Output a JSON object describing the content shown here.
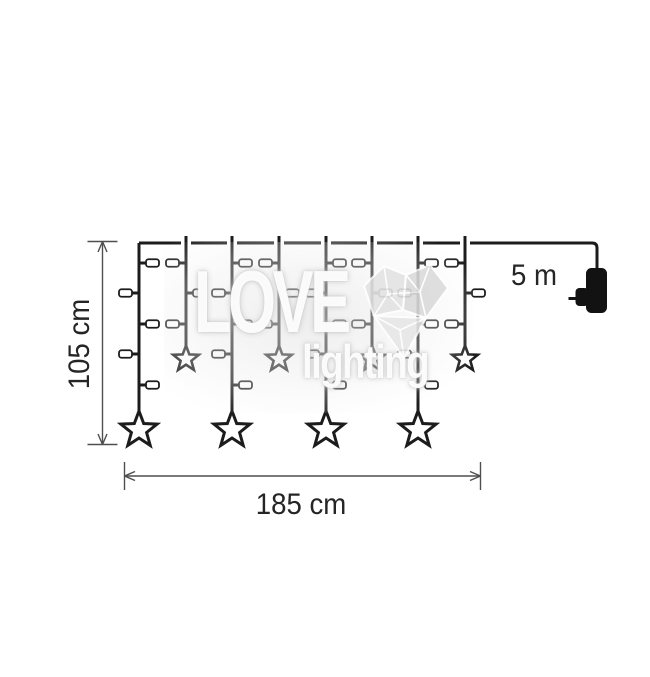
{
  "labels": {
    "height": "105 cm",
    "width": "185 cm",
    "cable_length": "5 m"
  },
  "watermark": {
    "line1": "LOVE",
    "line2": "lighting"
  },
  "colors": {
    "wire": "#1c1c1c",
    "dimension": "#4f4f4f",
    "text": "#252525",
    "plug": "#121212",
    "led_fill": "#ffffff",
    "star_fill": "#ffffff",
    "watermark_gray": "#e2e2e2"
  },
  "curtain": {
    "strand_count": 8,
    "strand_xs": [
      139,
      186,
      232,
      279,
      326,
      372,
      418,
      465
    ],
    "pattern": [
      "long",
      "short",
      "long",
      "short",
      "long",
      "short",
      "long",
      "short"
    ],
    "wire_y": 243,
    "wire_end_x": 597,
    "led_levels_y": [
      263,
      293,
      324,
      354,
      385
    ],
    "long_strand": {
      "led_sides": [
        "R",
        "L",
        "R",
        "L",
        "R"
      ],
      "star_center_y": 430,
      "star_outer_r": 19
    },
    "short_strand": {
      "led_sides": [
        "L",
        "R",
        "L"
      ],
      "star_center_y": 359,
      "star_outer_r": 13.5
    },
    "plug": {
      "x": 586,
      "y": 268,
      "w": 21,
      "h": 45
    }
  },
  "dimensions": {
    "vertical": {
      "x": 102.5,
      "y1": 241.5,
      "y2": 444.5
    },
    "horizontal": {
      "y": 476,
      "x1": 124.5,
      "x2": 480.5
    }
  }
}
